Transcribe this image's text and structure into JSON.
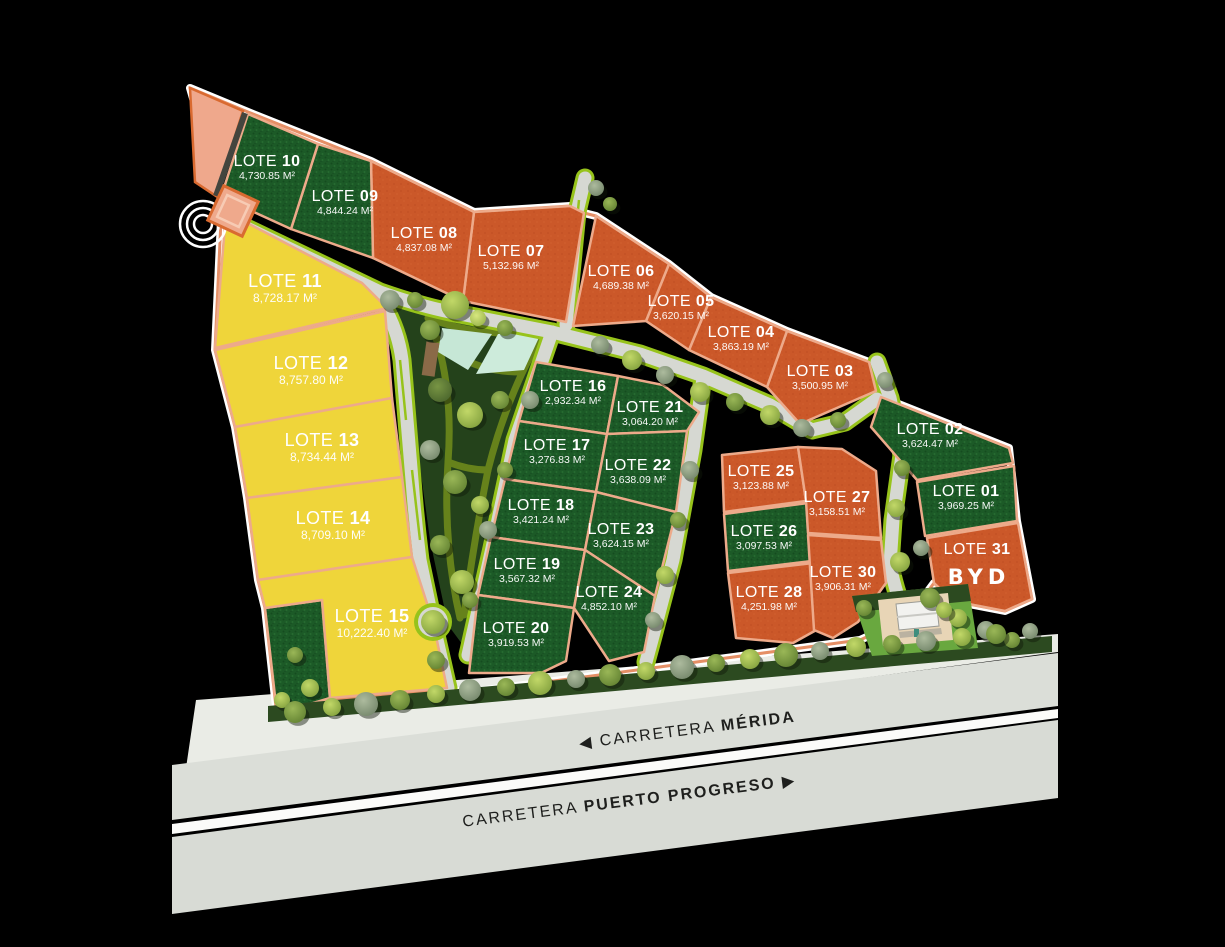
{
  "canvas": {
    "width": 1225,
    "height": 947,
    "background": "#000000"
  },
  "lot_label_prefix": "LOTE",
  "legend_roads": {
    "merida": {
      "prefix": "CARRETERA ",
      "name": "MÉRIDA",
      "arrow_glyph": "◀ ",
      "direction": "left"
    },
    "puerto_progreso": {
      "prefix": "CARRETERA ",
      "name": "PUERTO PROGRESO",
      "arrow_glyph": " ▶",
      "direction": "right"
    }
  },
  "colors": {
    "orange_lot": "#CB5829",
    "green_lot": "#1C5A27",
    "yellow_lot": "#EFD53A",
    "lot_border": "#EDAA8A",
    "site_border": "#E58F66",
    "road_fill": "#D6D8D2",
    "road_edge": "#97C31B",
    "park_green": "#24421B",
    "pool": "#C6E7D6",
    "highway_fill": "#DBDED8",
    "highway_stripe": "#FBFBF9",
    "frontage_strip": "#2C4A20",
    "ground_light": "#EAECE6",
    "label_text": "#FFFFFF",
    "highway_text": "#1E1F1D"
  },
  "lots": [
    {
      "number": "01",
      "area": "3,969.25 M²",
      "type": "green"
    },
    {
      "number": "02",
      "area": "3,624.47 M²",
      "type": "green"
    },
    {
      "number": "03",
      "area": "3,500.95 M²",
      "type": "orange"
    },
    {
      "number": "04",
      "area": "3,863.19 M²",
      "type": "orange"
    },
    {
      "number": "05",
      "area": "3,620.15 M²",
      "type": "orange"
    },
    {
      "number": "06",
      "area": "4,689.38 M²",
      "type": "orange"
    },
    {
      "number": "07",
      "area": "5,132.96 M²",
      "type": "orange"
    },
    {
      "number": "08",
      "area": "4,837.08 M²",
      "type": "orange"
    },
    {
      "number": "09",
      "area": "4,844.24 M²",
      "type": "green"
    },
    {
      "number": "10",
      "area": "4,730.85 M²",
      "type": "green"
    },
    {
      "number": "11",
      "area": "8,728.17 M²",
      "type": "yellow"
    },
    {
      "number": "12",
      "area": "8,757.80 M²",
      "type": "yellow"
    },
    {
      "number": "13",
      "area": "8,734.44 M²",
      "type": "yellow"
    },
    {
      "number": "14",
      "area": "8,709.10 M²",
      "type": "yellow"
    },
    {
      "number": "15",
      "area": "10,222.40 M²",
      "type": "yellow"
    },
    {
      "number": "16",
      "area": "2,932.34 M²",
      "type": "green"
    },
    {
      "number": "17",
      "area": "3,276.83 M²",
      "type": "green"
    },
    {
      "number": "18",
      "area": "3,421.24 M²",
      "type": "green"
    },
    {
      "number": "19",
      "area": "3,567.32 M²",
      "type": "green"
    },
    {
      "number": "20",
      "area": "3,919.53 M²",
      "type": "green"
    },
    {
      "number": "21",
      "area": "3,064.20 M²",
      "type": "green"
    },
    {
      "number": "22",
      "area": "3,638.09 M²",
      "type": "green"
    },
    {
      "number": "23",
      "area": "3,624.15 M²",
      "type": "green"
    },
    {
      "number": "24",
      "area": "4,852.10 M²",
      "type": "green"
    },
    {
      "number": "25",
      "area": "3,123.88 M²",
      "type": "orange"
    },
    {
      "number": "26",
      "area": "3,097.53 M²",
      "type": "green"
    },
    {
      "number": "27",
      "area": "3,158.51 M²",
      "type": "orange"
    },
    {
      "number": "28",
      "area": "4,251.98 M²",
      "type": "orange"
    },
    {
      "number": "30",
      "area": "3,906.31 M²",
      "type": "orange"
    },
    {
      "number": "31",
      "area": "",
      "type": "orange",
      "logo": "BYD"
    }
  ]
}
